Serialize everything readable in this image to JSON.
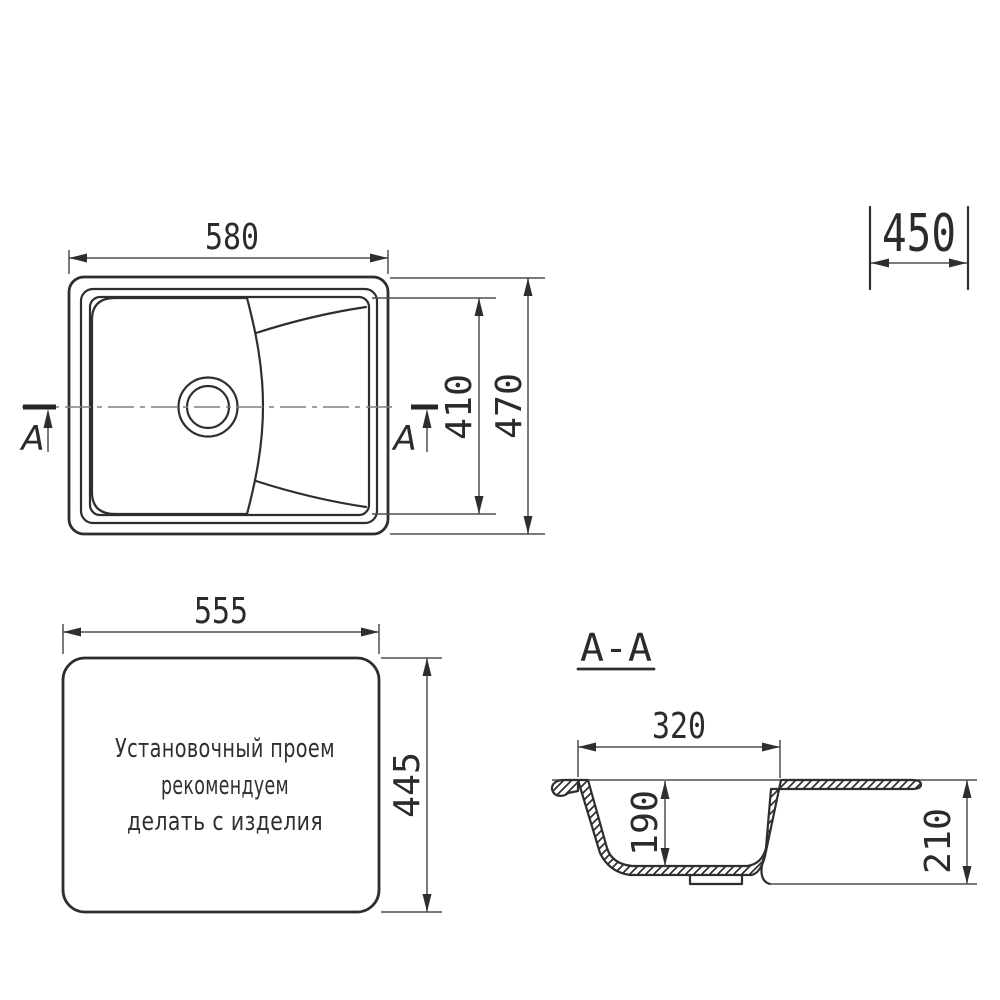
{
  "colors": {
    "background": "#ffffff",
    "line": "#2e2e2e",
    "thin_line": "#4f4f4f",
    "centerline": "#7f7f7f"
  },
  "plan_view": {
    "width_dim": "580",
    "bowl_length_dim": "410",
    "depth_dim": "470",
    "section_marker_left": "A",
    "section_marker_right": "A"
  },
  "overall_depth": {
    "value": "450"
  },
  "cutout_view": {
    "width_dim": "555",
    "height_dim": "445",
    "note_line1": "Установочный проем",
    "note_line2": "рекомендуем",
    "note_line3": "делать с изделия"
  },
  "section_view": {
    "title": "A-A",
    "opening_dim": "320",
    "bowl_depth_dim": "190",
    "height_dim": "210"
  }
}
